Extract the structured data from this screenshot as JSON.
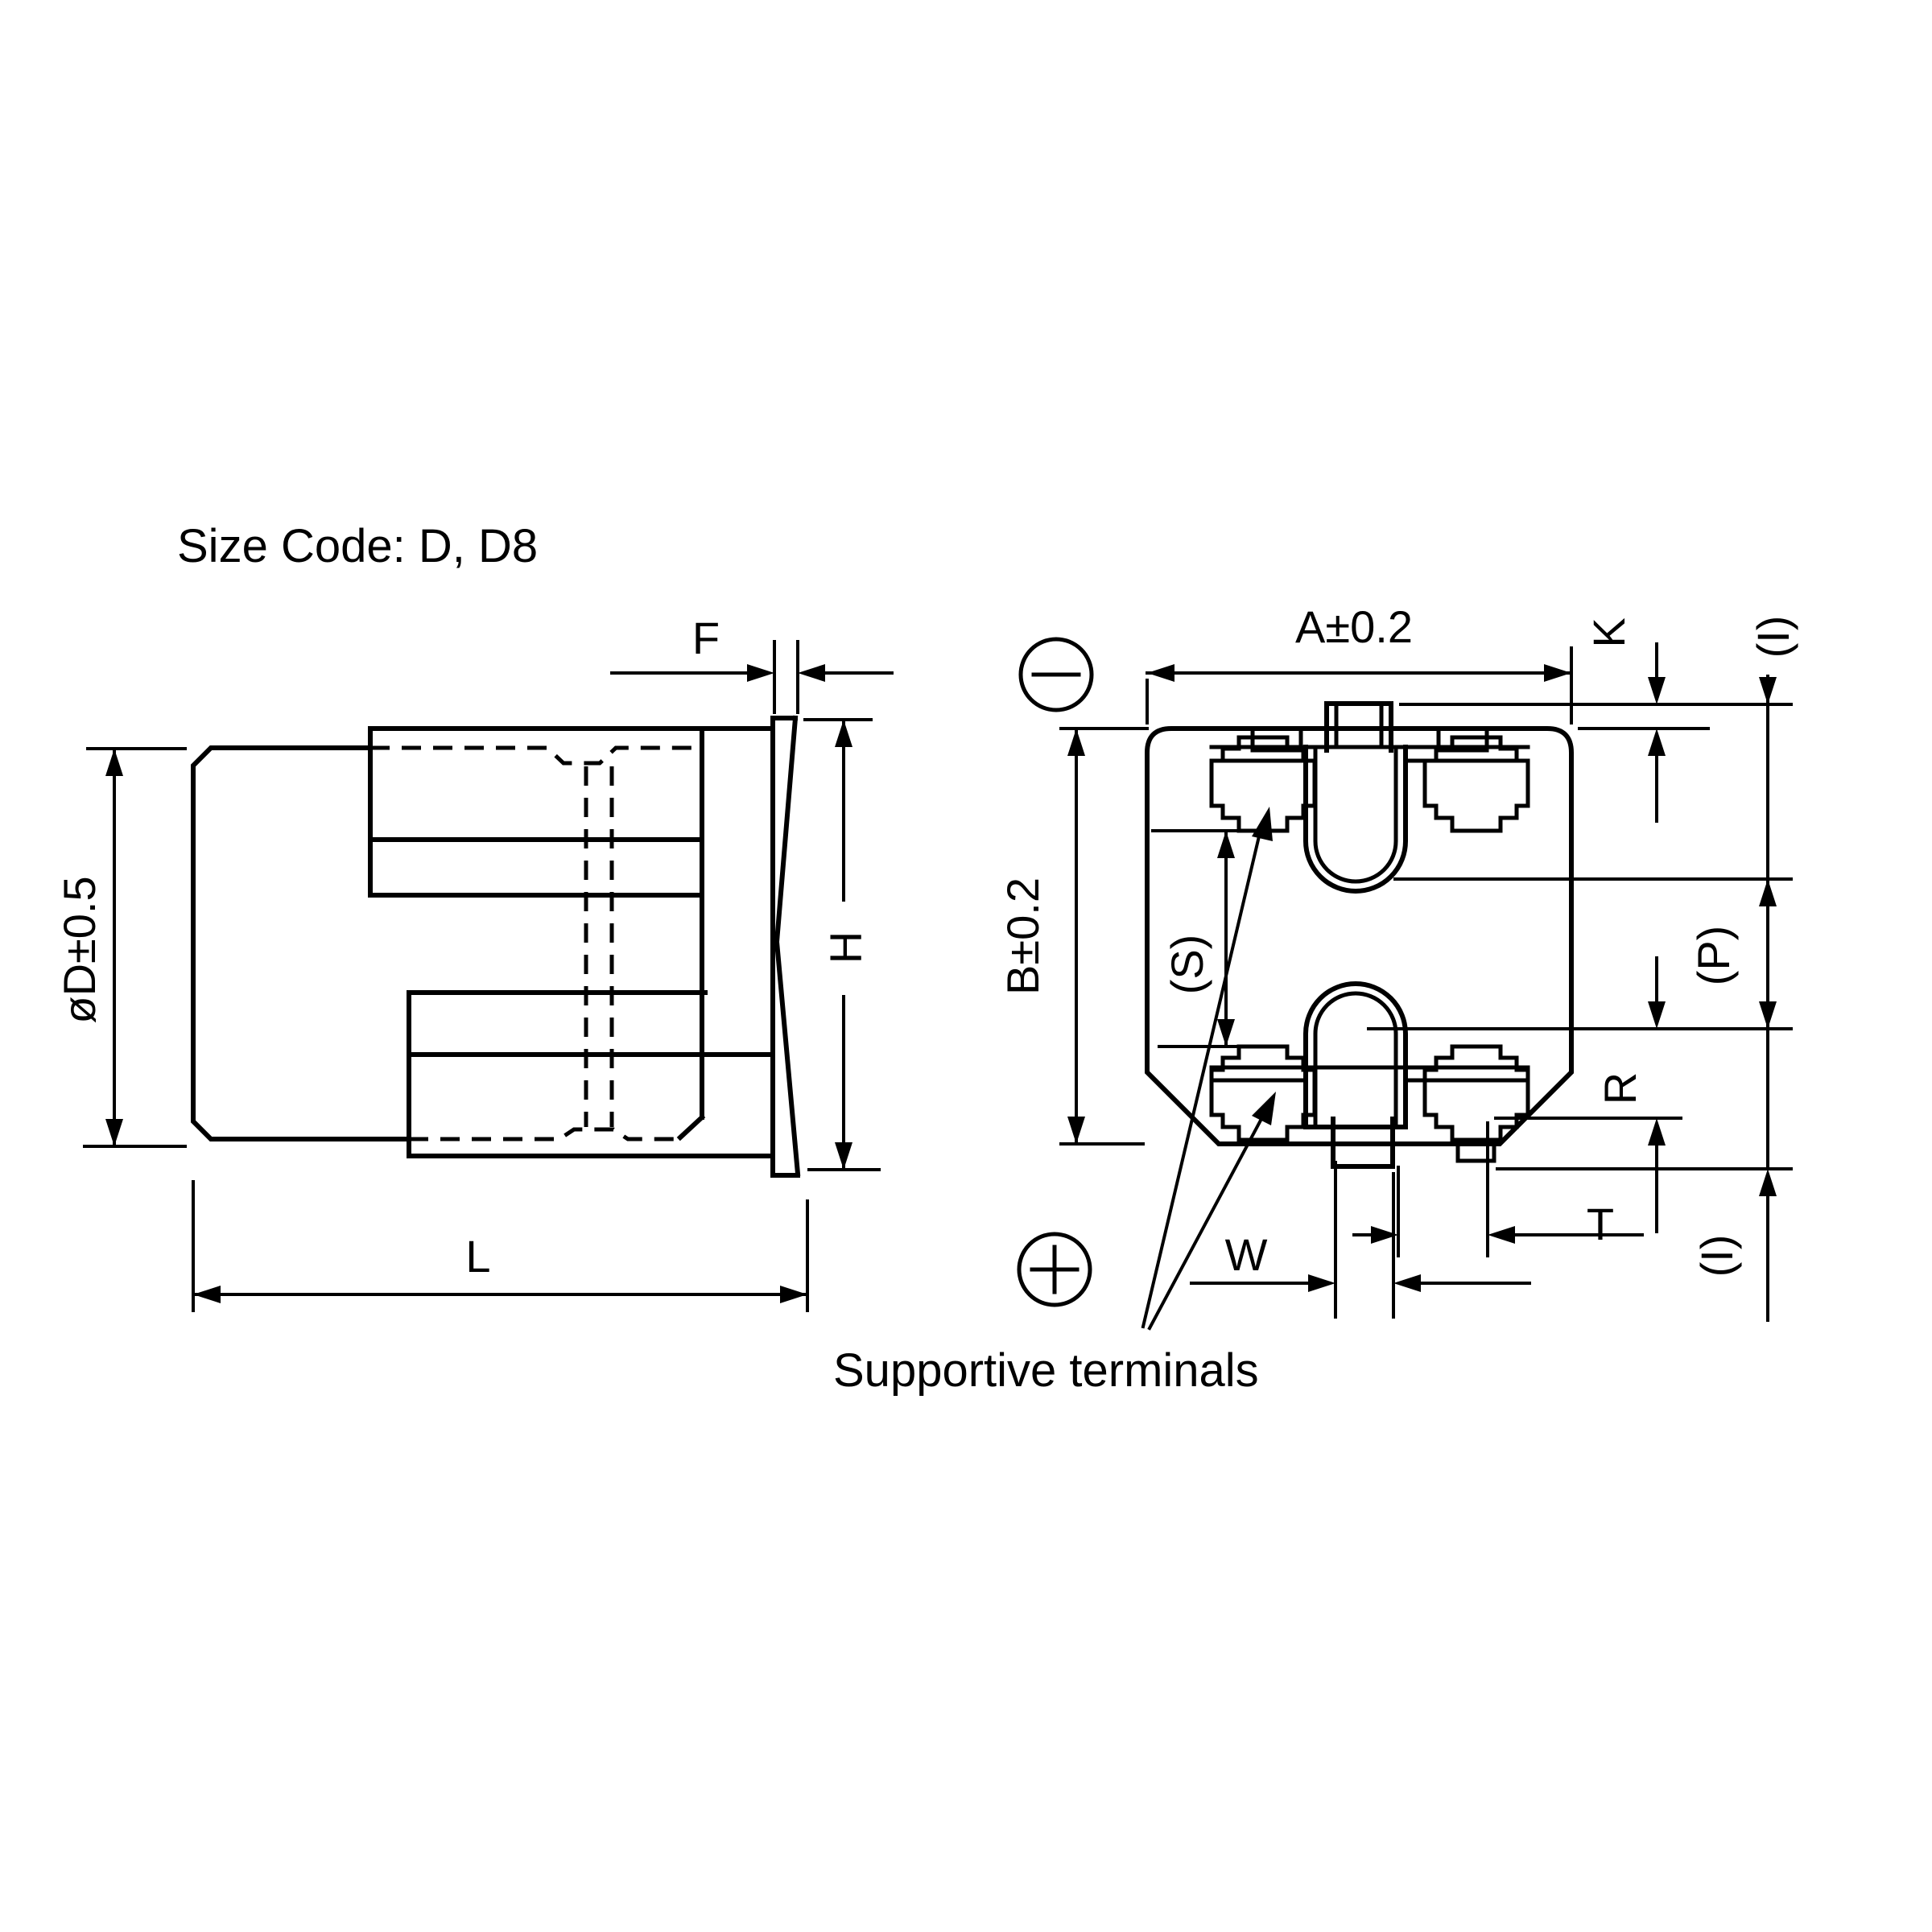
{
  "page": {
    "background_color": "#ffffff",
    "line_color": "#000000",
    "title": "Size Code: D, D8"
  },
  "labels": {
    "size_code": "Size Code: D, D8",
    "supportive": "Supportive terminals",
    "f": "F",
    "diameter": "øD±0.5",
    "h": "H",
    "l": "L",
    "a": "A±0.2",
    "k": "K",
    "i_top": "(I)",
    "b": "B±0.2",
    "s": "(S)",
    "p": "(P)",
    "r": "R",
    "w": "W",
    "t": "T",
    "i_bottom": "(I)"
  },
  "views": {
    "left": "capacitor side view with can, lead terminals and seating plate",
    "right": "capacitor bottom view with supportive terminals, bent leads and polarity marks"
  },
  "icons": {
    "polarity_negative": "minus-in-circle",
    "polarity_positive": "plus-in-circle"
  }
}
